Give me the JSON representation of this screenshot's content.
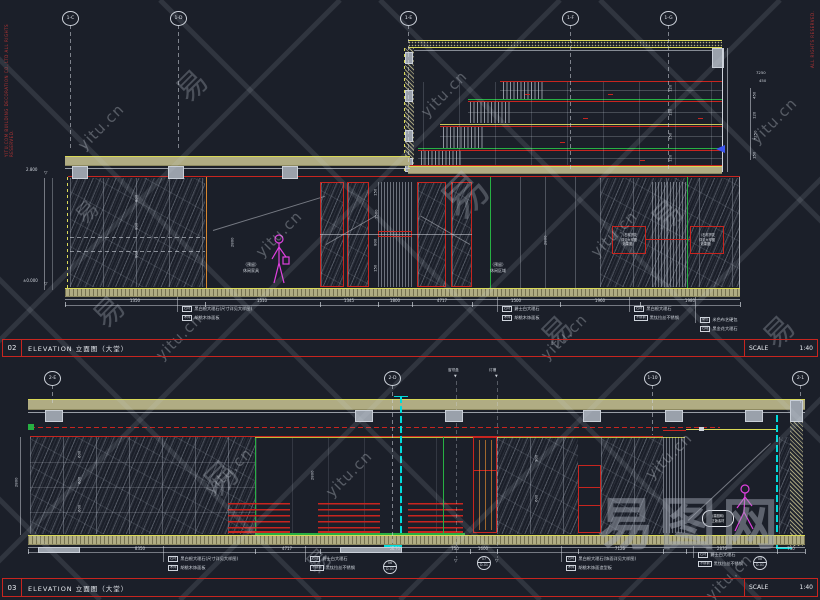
{
  "watermark": {
    "site": "yitu.cn",
    "char": "易",
    "brand": "易图网"
  },
  "copyright": {
    "left": "YITU.COM BUILDING DECORATION CO.,LTD ALL RIGHTS RESERVED.",
    "right": "ALL RIGHTS RESERVED."
  },
  "titlebars": [
    {
      "num": "02",
      "title": "ELEVATION 立面图（大堂）",
      "scale_label": "SCALE",
      "scale_value": "1:40"
    },
    {
      "num": "03",
      "title": "ELEVATION 立面图（大堂）",
      "scale_label": "SCALE",
      "scale_value": "1:40"
    }
  ],
  "grids": {
    "top": [
      "1-C",
      "1-D",
      "1-E",
      "1-F",
      "1-G"
    ],
    "bottom": [
      "2-E",
      "2-D",
      "1-10",
      "2-1"
    ],
    "mini": [
      "窗帘盒",
      "灯槽"
    ]
  },
  "d02": {
    "elev_top": "2.800",
    "elev_bottom": "±0.000",
    "heights": [
      "2800",
      "2800"
    ],
    "left_dims": [
      "800",
      "800",
      "800"
    ],
    "door_dims": [
      "150",
      "1500",
      "800",
      "150"
    ],
    "step_dims": [
      "120",
      "120",
      "150",
      "120"
    ],
    "right_dims": [
      "450",
      "120",
      "7250",
      "150"
    ],
    "top_right_dims": [
      "7250",
      "450"
    ],
    "dims_bottom": [
      "1350",
      "1510",
      "1345",
      "1800",
      "4717",
      "1500",
      "1960",
      "1980"
    ],
    "notes": [
      [
        "（石材拼花",
        "详见大样图",
        "效果图）"
      ],
      [
        "（石材拼花",
        "详见大样图",
        "效果图）"
      ]
    ],
    "reserve": [
      [
        "（预留）",
        "休闲家具"
      ],
      [
        "（预留）",
        "休闲区域"
      ]
    ],
    "callouts": [
      [
        [
          "石材",
          "黑白根大理石(尺寸详见大样图)"
        ],
        [
          "木饰",
          "胡桃木饰面板"
        ]
      ],
      [
        [
          "石材",
          "爵士白大理石"
        ],
        [
          "木饰",
          "胡桃木饰面板"
        ]
      ],
      [
        [
          "石材",
          "黑白根大理石"
        ],
        [
          "不锈钢",
          "黑钛拉丝不锈钢"
        ]
      ],
      [
        [
          "硬包",
          "米色布艺硬包"
        ],
        [
          "石材",
          "黑金花大理石"
        ]
      ]
    ]
  },
  "d03": {
    "height": "2800",
    "mid_dims": [
      "2800",
      "900",
      "600"
    ],
    "left_dims": [
      "600",
      "600",
      "600"
    ],
    "dims_bottom": [
      "8350",
      "4717",
      "2170",
      "750",
      "1600",
      "7125",
      "2870",
      "750"
    ],
    "callouts": [
      [
        [
          "石材",
          "黑白根大理石(尺寸详见大样图)"
        ],
        [
          "木饰",
          "胡桃木饰面板"
        ]
      ],
      [
        [
          "石材",
          "爵士白大理石"
        ],
        [
          "不锈钢",
          "黑钛拉丝不锈钢"
        ]
      ],
      [
        [
          "石材",
          "黑白根大理石(饰面详见大样图)"
        ],
        [
          "木饰",
          "胡桃木饰面造型板"
        ]
      ],
      [
        [
          "石材",
          "爵士白大理石"
        ],
        [
          "不锈钢",
          "黑钛拉丝不锈钢"
        ]
      ]
    ],
    "circles": [
      {
        "top": "06",
        "bot": "D-01"
      },
      {
        "top": "07",
        "bot": "D-01"
      },
      {
        "top": "08",
        "bot": "D-01"
      }
    ],
    "badge": [
      "（易图网）",
      "正版素材"
    ]
  }
}
